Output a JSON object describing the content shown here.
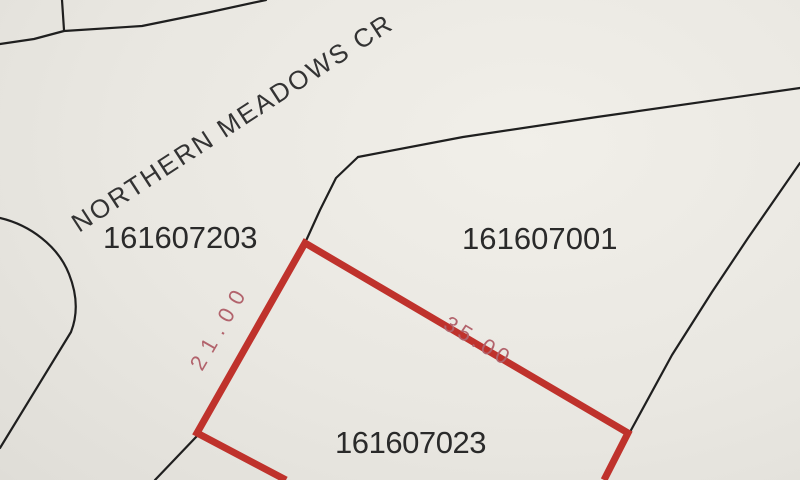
{
  "street": {
    "name": "NORTHERN MEADOWS CR"
  },
  "parcels": [
    {
      "id": "161607203",
      "highlighted": false
    },
    {
      "id": "161607001",
      "highlighted": false
    },
    {
      "id": "161607023",
      "highlighted": true,
      "boundary_dimensions": [
        {
          "label": "21.00",
          "side": "northwest"
        },
        {
          "label": "35.00",
          "side": "northeast"
        }
      ]
    }
  ],
  "colors": {
    "background": "#e9e7e1",
    "boundary_line": "#1f1f1f",
    "highlight_boundary": "#bf322c",
    "dimension_text": "#b2636c",
    "parcel_label_text": "#2a2a2a"
  }
}
